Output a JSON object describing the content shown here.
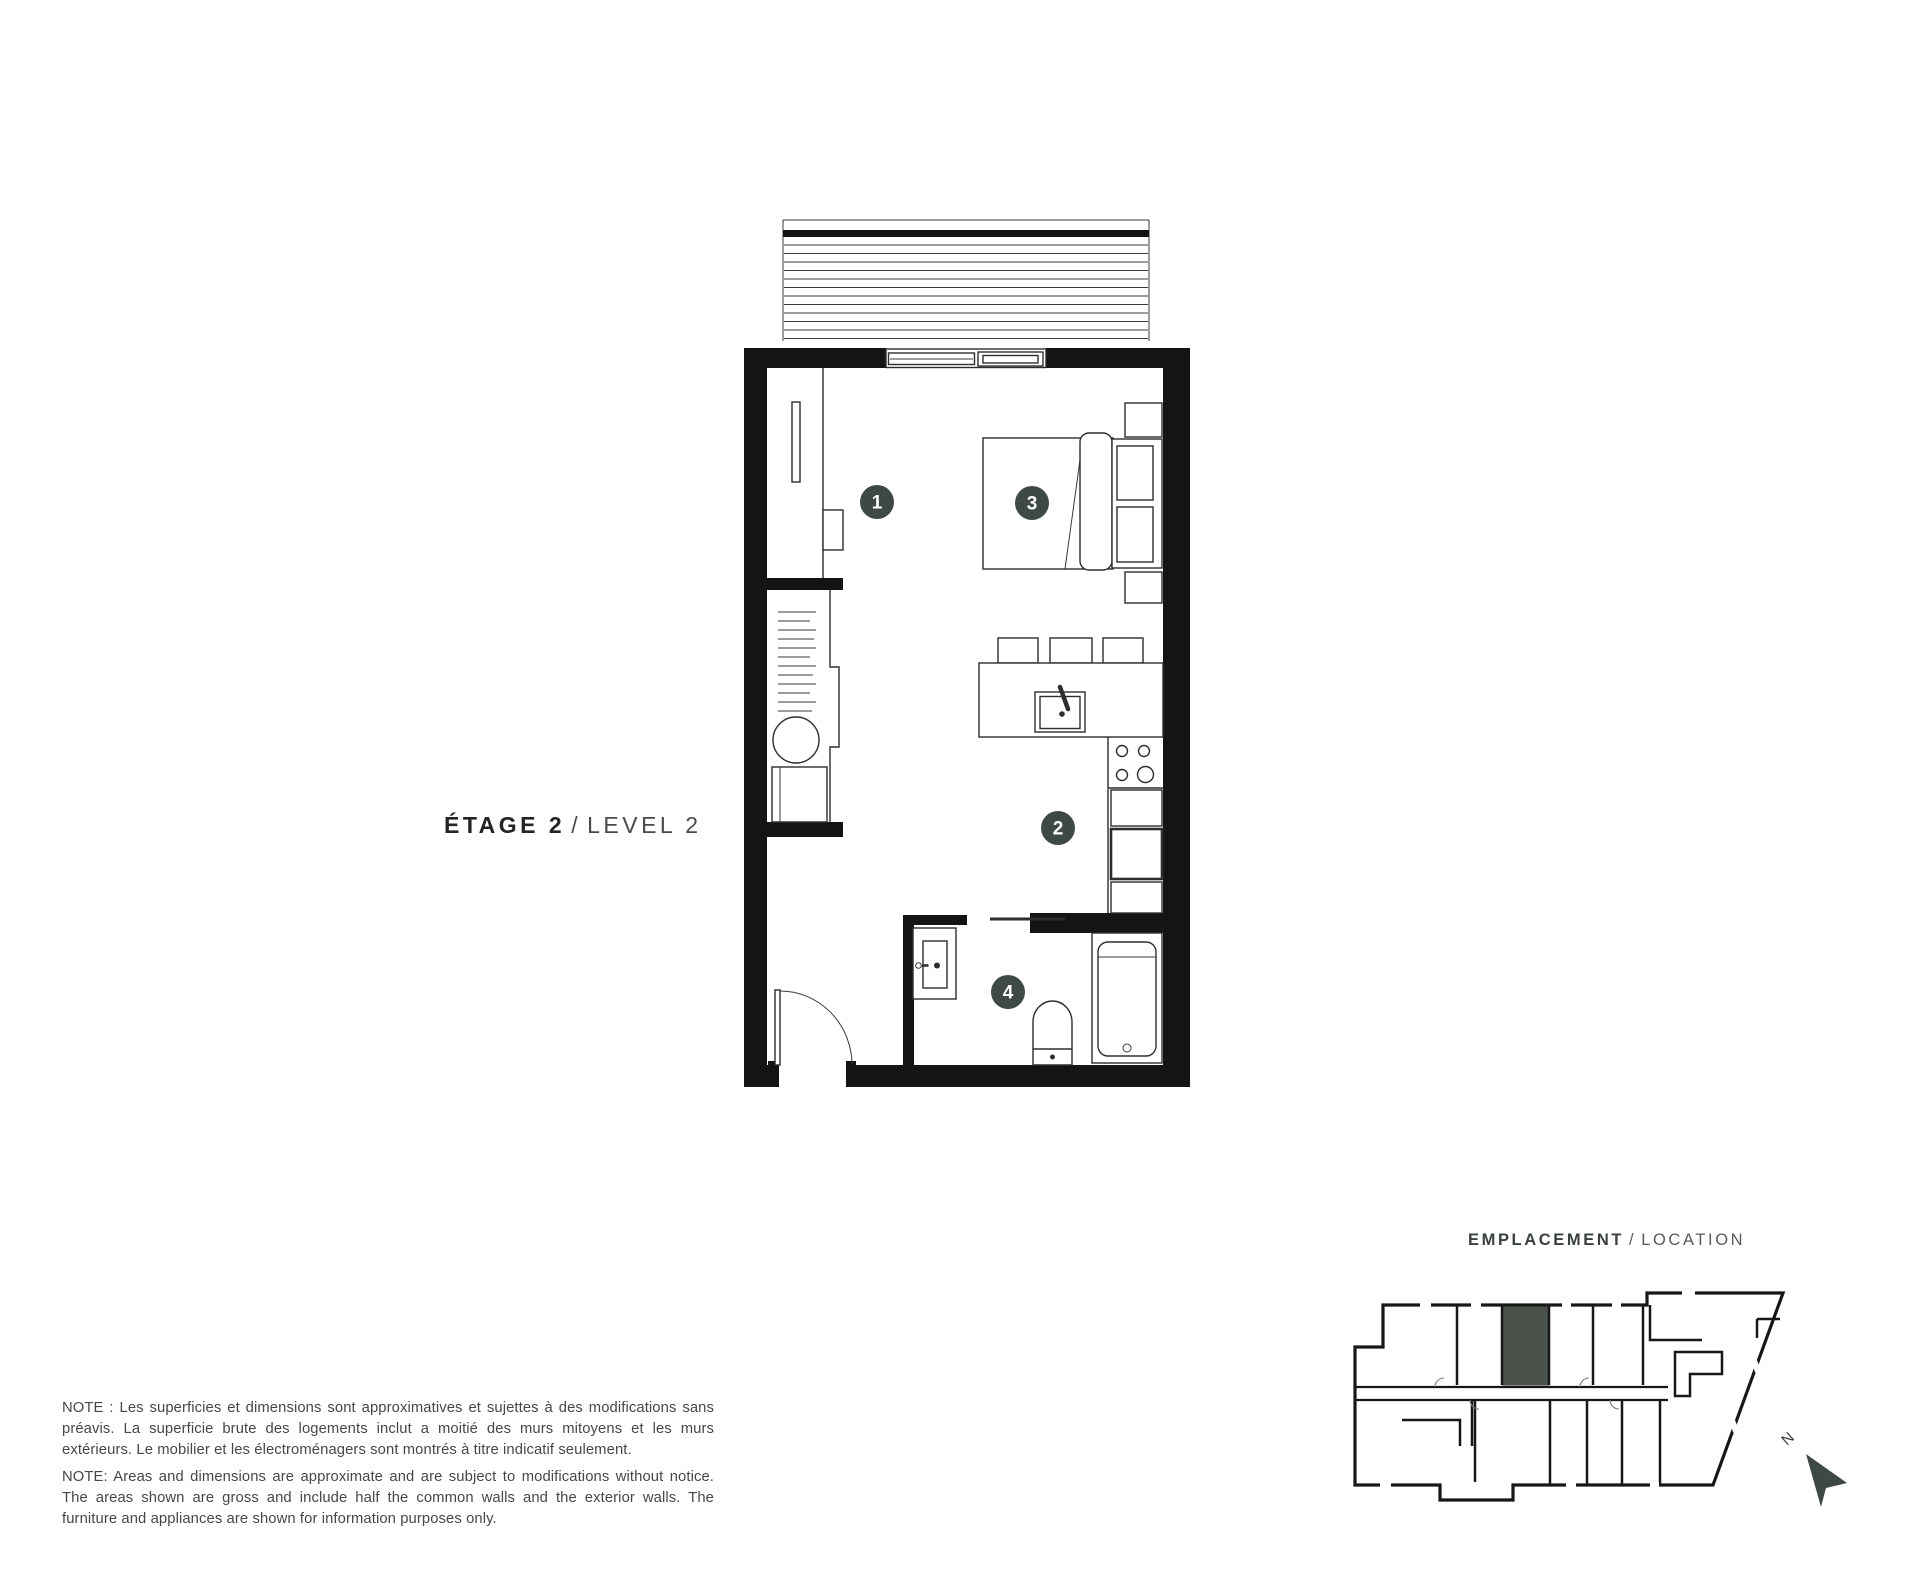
{
  "palette": {
    "wall": "#141414",
    "line": "#2e2e2e",
    "accent": "#3e4943",
    "unit_highlight": "#4a514a"
  },
  "floor_title": {
    "primary": "ÉTAGE 2",
    "separator": "/",
    "secondary": "LEVEL 2"
  },
  "plan_markers": [
    {
      "number": "1"
    },
    {
      "number": "2"
    },
    {
      "number": "3"
    },
    {
      "number": "4"
    }
  ],
  "location": {
    "primary": "EMPLACEMENT",
    "separator": "/",
    "secondary": "LOCATION",
    "north": "N"
  },
  "notes": {
    "french": "NOTE : Les superficies et dimensions sont approximatives et sujettes à des modifications sans préavis. La superficie brute des logements inclut a moitié des murs mitoyens et les murs extérieurs. Le mobilier et les électroménagers sont montrés à titre indicatif seulement.",
    "english": "NOTE: Areas and dimensions are approximate and are subject to modifications without notice. The areas shown are gross and include half the common walls and the exterior walls. The furniture and appliances are shown for information purposes only."
  }
}
